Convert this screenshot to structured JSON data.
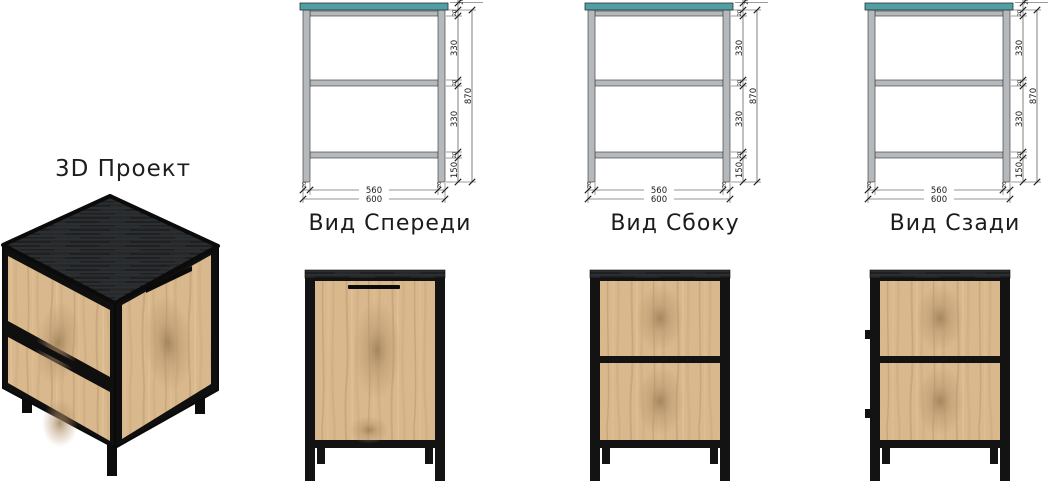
{
  "project": {
    "title": "3D Проект"
  },
  "views": [
    {
      "id": "front",
      "label": "Вид Спереди",
      "render": "door",
      "hinges": false
    },
    {
      "id": "side",
      "label": "Вид Сбоку",
      "render": "panels",
      "hinges": false
    },
    {
      "id": "back",
      "label": "Вид Сзади",
      "render": "panels",
      "hinges": true
    }
  ],
  "dimensions": {
    "overall_height": "870",
    "section_top": "330",
    "section_bottom": "330",
    "leg_height": "150",
    "frame_profile": "20",
    "inner_width": "560",
    "overall_width": "600"
  },
  "colors": {
    "top_plate_teal": "#4f9fa5",
    "frame_gray": "#b5b9bb",
    "metal_black": "#131313",
    "wood_light_oak": "#d9b88d",
    "dark_top": "#26282a",
    "dimension_ink": "#222222",
    "background": "#ffffff"
  }
}
